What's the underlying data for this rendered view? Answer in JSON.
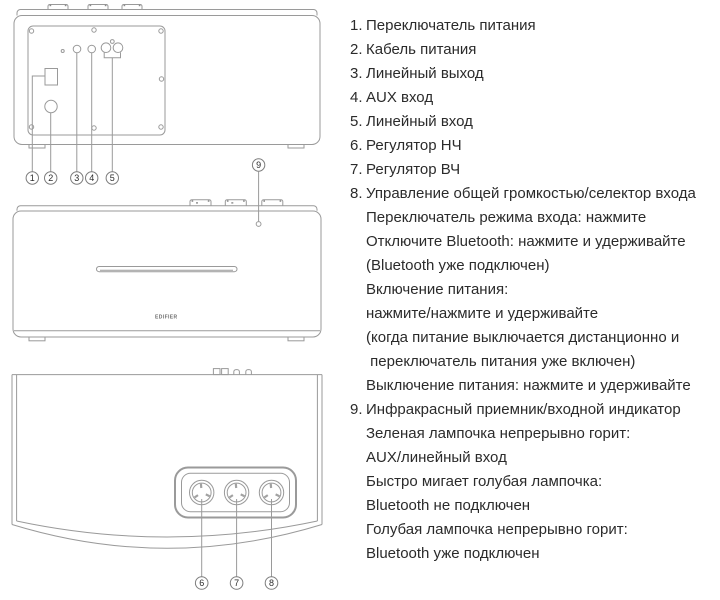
{
  "colors": {
    "line": "#9a9a9a",
    "ink": "#2b2b2b"
  },
  "figure": {
    "brand": "EDIFIER",
    "callouts": {
      "c1": "1",
      "c2": "2",
      "c3": "3",
      "c4": "4",
      "c5": "5",
      "c6": "6",
      "c7": "7",
      "c8": "8",
      "c9": "9"
    }
  },
  "parts_list": [
    {
      "num": "1.",
      "lines": [
        "Переключатель питания"
      ]
    },
    {
      "num": "2.",
      "lines": [
        "Кабель питания"
      ]
    },
    {
      "num": "3.",
      "lines": [
        "Линейный выход"
      ]
    },
    {
      "num": "4.",
      "lines": [
        "AUX вход"
      ]
    },
    {
      "num": "5.",
      "lines": [
        "Линейный вход"
      ]
    },
    {
      "num": "6.",
      "lines": [
        "Регулятор НЧ"
      ]
    },
    {
      "num": "7.",
      "lines": [
        "Регулятор ВЧ"
      ]
    },
    {
      "num": "8.",
      "lines": [
        "Управление общей громкостью/селектор входа",
        "Переключатель режима входа: нажмите",
        "Отключите Bluetooth: нажмите и удерживайте",
        "(Bluetooth уже подключен)",
        "Включение питания:",
        "нажмите/нажмите и удерживайте",
        "(когда питание выключается дистанционно и",
        " переключатель питания уже включен)",
        "Выключение питания: нажмите и удерживайте"
      ]
    },
    {
      "num": "9.",
      "lines": [
        "Инфракрасный приемник/входной индикатор",
        "Зеленая лампочка непрерывно горит:",
        "AUX/линейный вход",
        "Быстро мигает голубая лампочка:",
        "Bluetooth не подключен",
        "Голубая лампочка непрерывно горит:",
        "Bluetooth уже подключен"
      ]
    }
  ]
}
